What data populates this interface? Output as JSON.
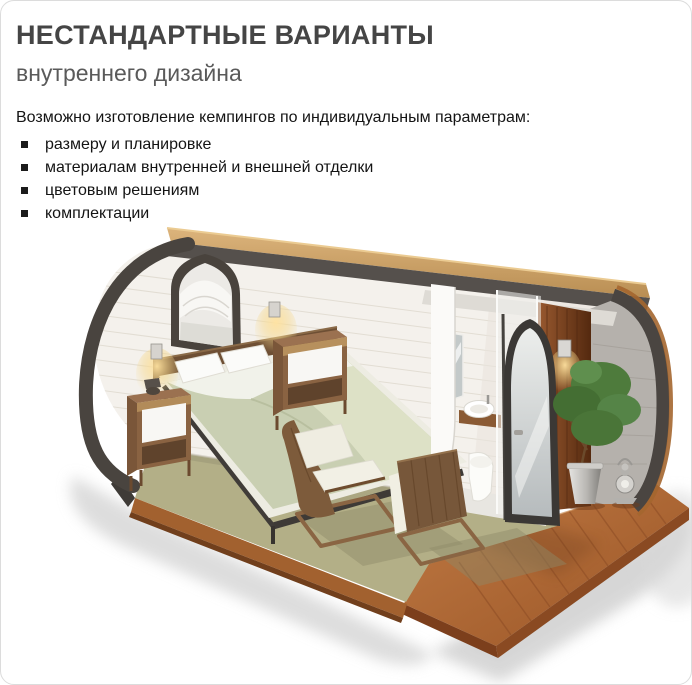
{
  "header": {
    "title": "НЕСТАНДАРТНЫЕ ВАРИАНТЫ",
    "subtitle": "внутреннего дизайна",
    "title_color": "#454545"
  },
  "body": {
    "intro": "Возможно изготовление кемпингов по индивидуальным параметрам:",
    "bullets": [
      "размеру и планировке",
      "материалам внутренней и внешней отделки",
      "цветовым решениям",
      "комплектации"
    ]
  },
  "illustration": {
    "description": "3D cutaway render of a camping pod: bedroom with double bed, two wooden nightstands with lit wall sconces, pointed-arch window with curtain, two wooden cantilever chairs, bathroom with mirror, round sink on wooden vanity and toilet, open arched glass door, green potted plant, lantern, olive-green carpet and red-brown wooden deck",
    "colors": {
      "frame": "#49443f",
      "roof_wood": "#cda468",
      "wall": "#f4f1ec",
      "carpet": "#b3af87",
      "deck_wood": "#b06a3a",
      "inner_wood": "#7c4424",
      "bedding": "#c9cfb2",
      "plant": "#4d7a3d",
      "cushion": "#f2f0e5"
    }
  }
}
